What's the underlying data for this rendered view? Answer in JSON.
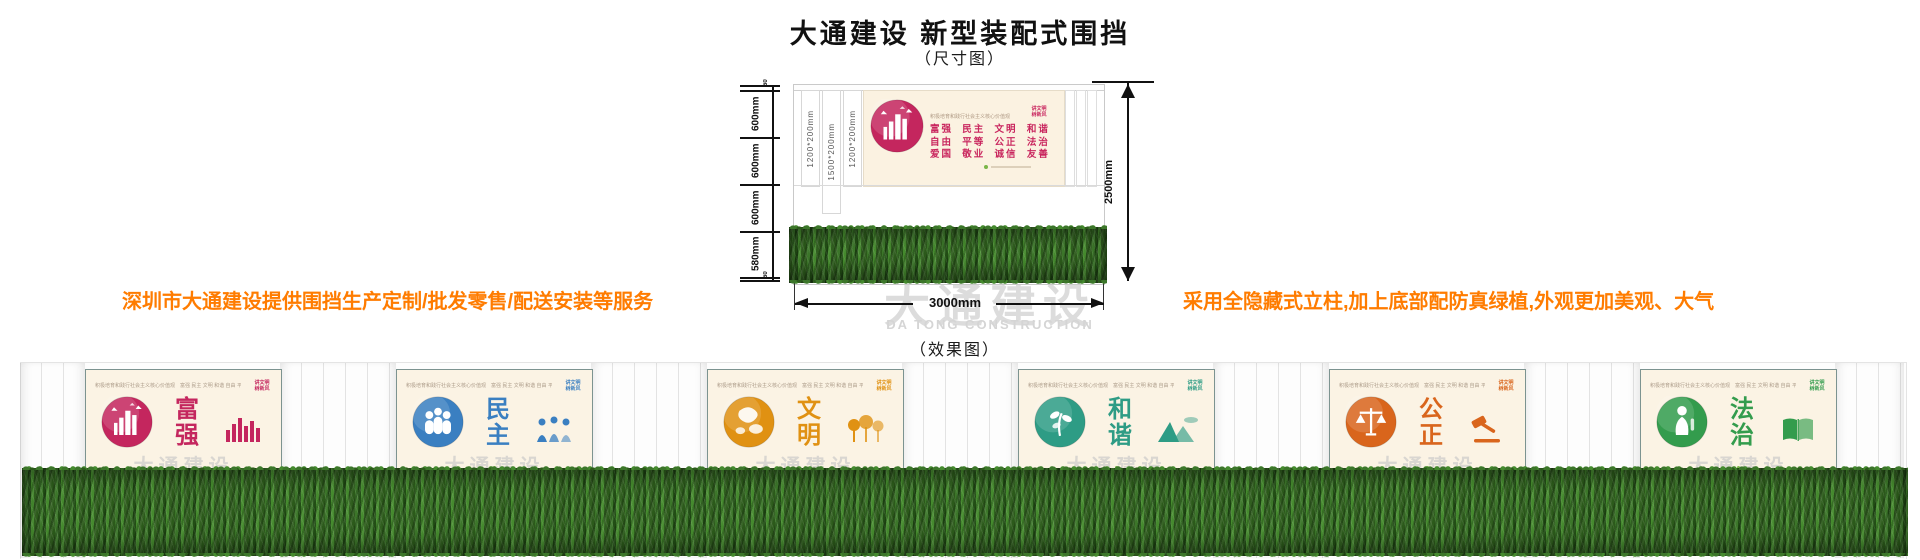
{
  "header": {
    "title": "大通建设 新型装配式围挡",
    "dimension_caption": "（尺寸图）",
    "effect_caption": "（效果图）"
  },
  "annotations": {
    "left": "深圳市大通建设提供围挡生产定制/批发零售/配送安装等服务",
    "right": "采用全隐藏式立柱,加上底部配防真绿植,外观更加美观、大气",
    "color": "#FF7C00"
  },
  "watermark": {
    "cn": "大通建设",
    "en": "DA TONG CONSTRUCTION"
  },
  "dimensions": {
    "left_segments": [
      "60",
      "600mm",
      "600mm",
      "600mm",
      "580mm",
      "60"
    ],
    "height_total": "2500mm",
    "width_total": "3000mm",
    "post_labels": [
      "1200*200mm",
      "1500*200mm",
      "1200*200mm"
    ]
  },
  "banner": {
    "slogan": "积极培育和践行社会主义核心价值观",
    "corner_lines": [
      "讲文明",
      "树新风"
    ],
    "value_lines": [
      "富强  民主  文明  和谐",
      "自由  平等  公正  法治",
      "爱国  敬业  诚信  友善"
    ]
  },
  "effect": {
    "panel_watermark": "大通建设",
    "panels": [
      {
        "title": "富强",
        "color": "#C4265E",
        "art": "city",
        "icon": "bars"
      },
      {
        "title": "民主",
        "color": "#3A7FC1",
        "art": "people",
        "icon": "figures"
      },
      {
        "title": "文明",
        "color": "#E09112",
        "art": "globe",
        "icon": "trees"
      },
      {
        "title": "和谐",
        "color": "#2E9C85",
        "art": "plant",
        "icon": "mountain"
      },
      {
        "title": "公正",
        "color": "#D9651C",
        "art": "scales",
        "icon": "gavel"
      },
      {
        "title": "法治",
        "color": "#339C4D",
        "art": "figure",
        "icon": "book"
      }
    ]
  }
}
